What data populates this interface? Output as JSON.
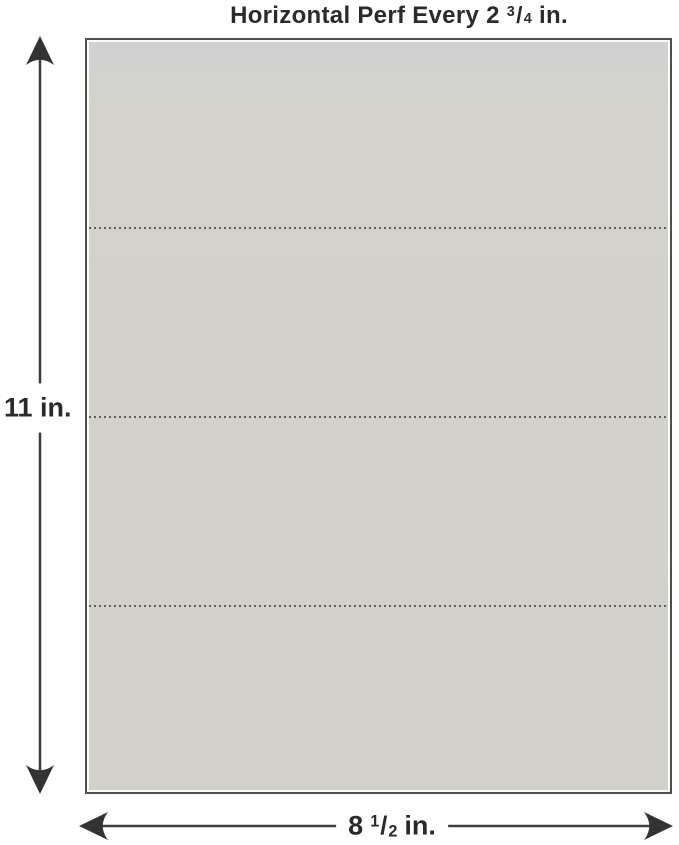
{
  "title": {
    "text_prefix": "Horizontal Perf Every 2",
    "fraction_numerator": "3",
    "fraction_slash": "/",
    "fraction_denominator": "4",
    "text_suffix": "in."
  },
  "sheet": {
    "fill_color": "#d2d1ca",
    "border_color": "#4e4e4c",
    "perforation_color": "#504e49",
    "perforation_line_count": 3,
    "perforation_style": "dotted"
  },
  "dimensions": {
    "arrow_color": "#333333",
    "line_color": "#3e3e3e",
    "height": {
      "label": "11 in."
    },
    "width": {
      "prefix": "8",
      "fraction_numerator": "1",
      "fraction_slash": "/",
      "fraction_denominator": "2",
      "suffix": "in."
    }
  }
}
